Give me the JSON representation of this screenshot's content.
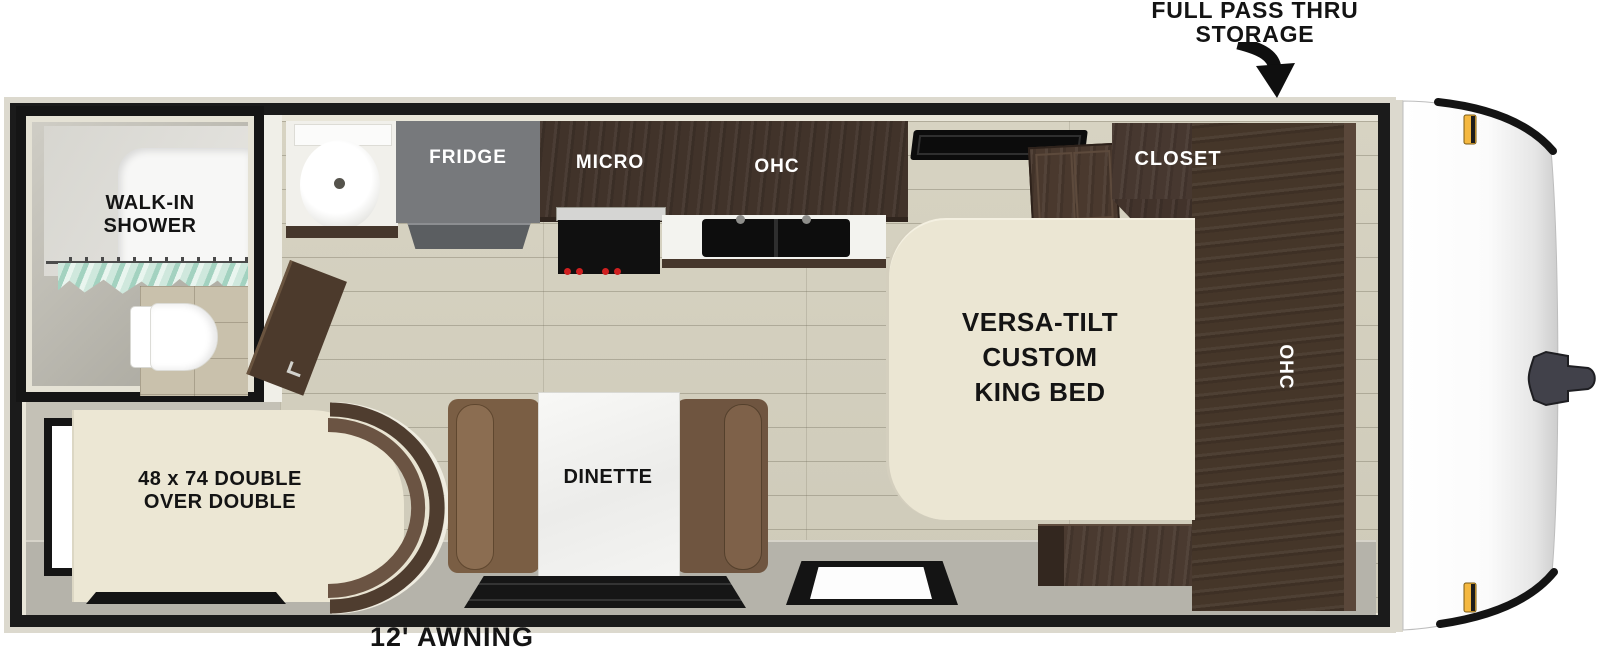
{
  "type": "rv-floorplan",
  "labels": {
    "pass_thru_line1": "FULL PASS THRU",
    "pass_thru_line2": "STORAGE",
    "shower_line1": "WALK-IN",
    "shower_line2": "SHOWER",
    "fridge": "FRIDGE",
    "micro": "MICRO",
    "kitchen_ohc": "OHC",
    "closet": "CLOSET",
    "wardrobe_ohc": "OHC",
    "king_bed_line1": "VERSA-TILT",
    "king_bed_line2": "CUSTOM",
    "king_bed_line3": "KING BED",
    "bunk_line1": "48 x 74 DOUBLE",
    "bunk_line2": "OVER DOUBLE",
    "dinette": "DINETTE",
    "awning": "12' AWNING"
  },
  "colors": {
    "wall_black": "#1b1b1b",
    "trim_cream": "#dcd9ce",
    "floor_wood": "#d3cfbe",
    "floor_grey": "#b5b3aa",
    "cabinet_dark_brown": "#43342b",
    "fridge_grey": "#77797c",
    "mattress_cream": "#ebe6d3",
    "bench_brown": "#7a5e44",
    "curtain_teal": "#b9dccf",
    "marker_light_amber": "#f5b840",
    "stove_knob_red": "#cf2020"
  }
}
